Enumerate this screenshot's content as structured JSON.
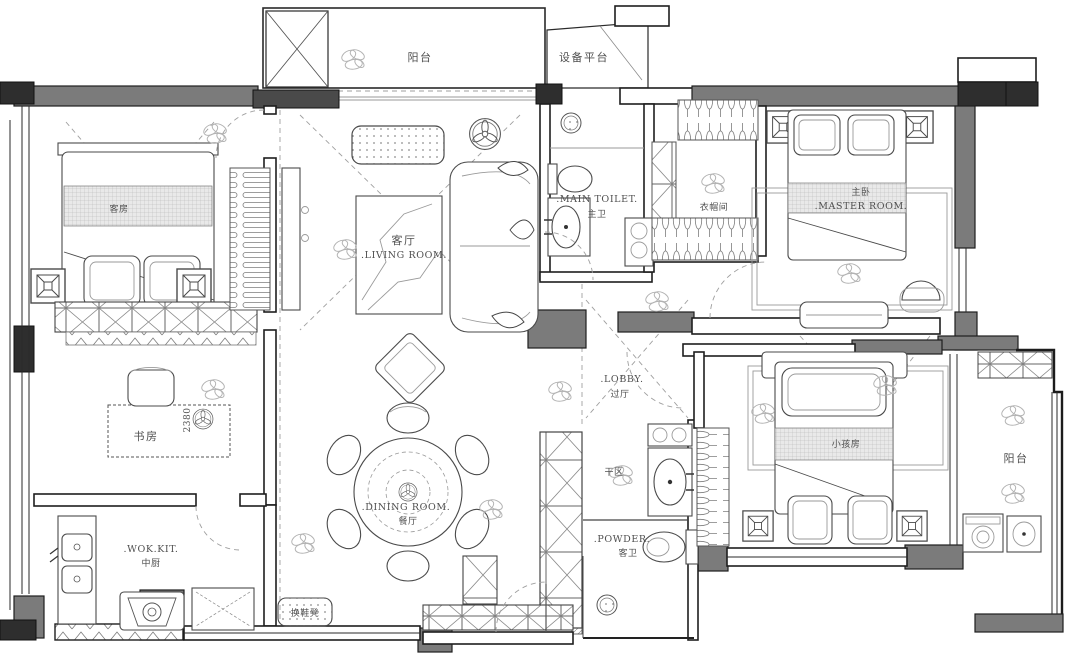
{
  "plan": {
    "colors": {
      "wall": "#7b7b7b",
      "line": "#2e2e2e",
      "background": "#ffffff"
    },
    "rooms": {
      "balcony_top": {
        "cn": "阳台"
      },
      "equipment_platform": {
        "cn": "设备平台"
      },
      "guest_room": {
        "cn": "客房"
      },
      "living_room": {
        "cn": "客厅",
        "en": ".LIVING ROOM."
      },
      "main_toilet": {
        "en": ".MAIN TOILET.",
        "cn": "主卫"
      },
      "cloakroom": {
        "cn": "衣帽间"
      },
      "master_room": {
        "cn": "主卧",
        "en": ".MASTER ROOM."
      },
      "study": {
        "cn": "书房"
      },
      "lobby": {
        "en": ".LOBBY.",
        "cn": "过厅"
      },
      "dry_area": {
        "cn": "干区"
      },
      "dining_room": {
        "en": ".DINING ROOM.",
        "cn": "餐厅"
      },
      "wok_kitchen": {
        "en": ".WOK.KIT.",
        "cn": "中厨"
      },
      "powder_room": {
        "en": ".POWDER.",
        "cn": "客卫"
      },
      "kids_room": {
        "cn": "小孩房"
      },
      "balcony_right": {
        "cn": "阳台"
      }
    },
    "annotations": {
      "shoe_bench": "换鞋凳",
      "study_depth": "2380"
    }
  }
}
